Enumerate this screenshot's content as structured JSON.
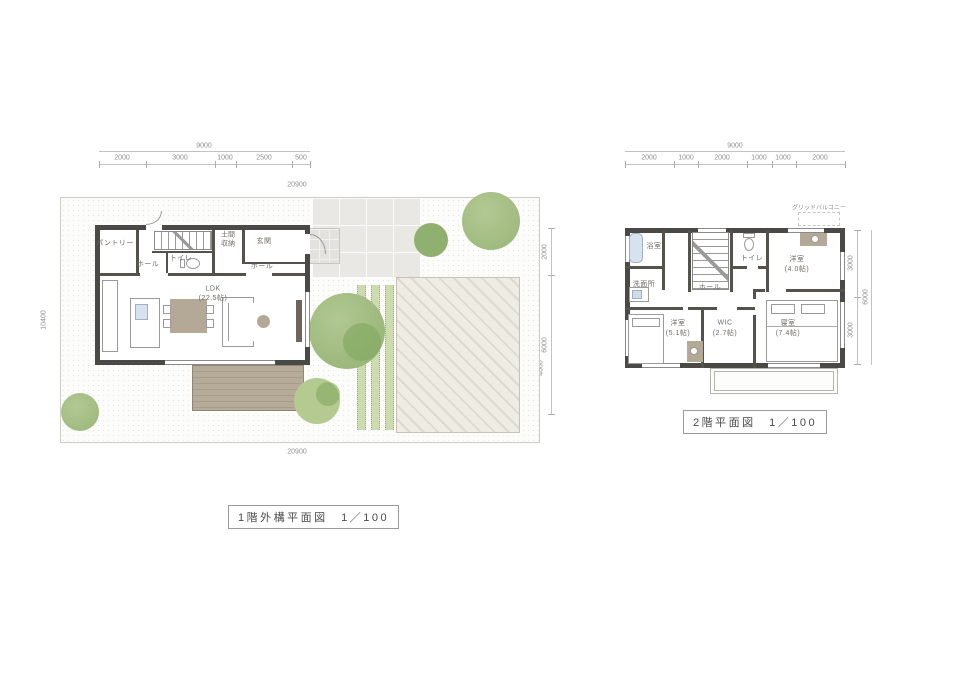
{
  "plan1": {
    "caption": "1階外構平面図　1／100",
    "dim_total_top": "9000",
    "dim_top_segments": [
      "2000",
      "3000",
      "1000",
      "2500",
      "500"
    ],
    "site_width_top": "20900",
    "site_width_bottom": "20900",
    "site_height_left": "10400",
    "dim_right_segments": [
      "2000",
      "6000"
    ],
    "dim_right_inner": [
      "10400",
      "4000"
    ],
    "rooms": {
      "pantry": "パントリー",
      "hall_a": "ホール",
      "toilet": "トイレ",
      "doma_storage": "土間収納",
      "entrance": "玄関",
      "hall_b": "ホール",
      "ldk": "LDK",
      "ldk_size": "(22.5帖)"
    }
  },
  "plan2": {
    "caption": "2階平面図　1／100",
    "dim_total_top": "9000",
    "dim_top_segments": [
      "2000",
      "1000",
      "2000",
      "1000",
      "1000",
      "2000"
    ],
    "dim_right_segments": [
      "3000",
      "3000"
    ],
    "dim_right_total": "6000",
    "rooms": {
      "bath": "浴室",
      "washroom": "洗面所",
      "toilet": "トイレ",
      "hall": "ホール",
      "bedroom_a": "洋室",
      "bedroom_a_size": "(4.0帖)",
      "master_bedroom": "寝室",
      "master_bedroom_size": "(7.4帖)",
      "wic": "WIC",
      "wic_size": "(2.7帖)",
      "bedroom_b": "洋室",
      "bedroom_b_size": "(5.1帖)",
      "balcony": "グリッドバルコニー"
    }
  },
  "colors": {
    "wall": "#4b4945",
    "wood": "#b4a997",
    "tree_green": "#9db97d",
    "hedge_green": "#cddcae",
    "water_blue": "#d6e2f0",
    "hatch_beige": "#e3dfd4"
  }
}
